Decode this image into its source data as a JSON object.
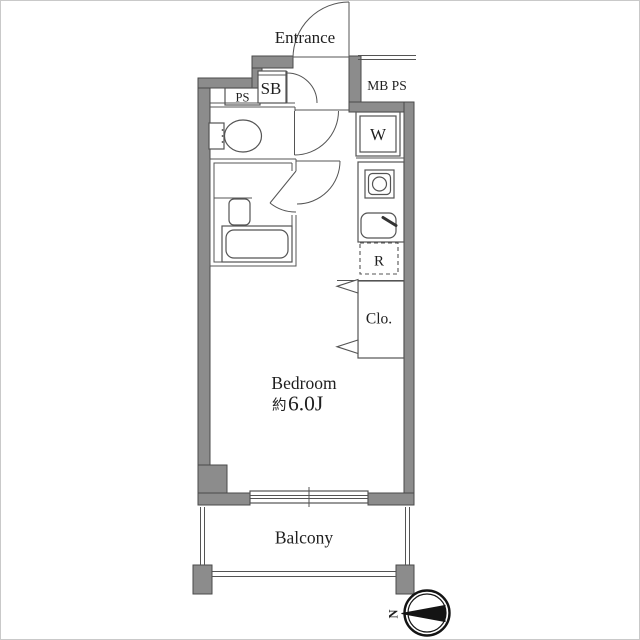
{
  "labels": {
    "entrance": "Entrance",
    "mb_ps": "MB PS",
    "ps": "PS",
    "sb": "SB",
    "washer": "W",
    "refrigerator": "R",
    "closet": "Clo.",
    "bedroom": "Bedroom",
    "bedroom_area_prefix": "約",
    "bedroom_area": "6.0J",
    "balcony": "Balcony",
    "compass_north": "N"
  },
  "colors": {
    "wall_fill": "#8c8c8c",
    "wall_edge": "#4a4a4a",
    "line": "#545454",
    "text": "#1f1f1f",
    "background": "#ffffff"
  }
}
